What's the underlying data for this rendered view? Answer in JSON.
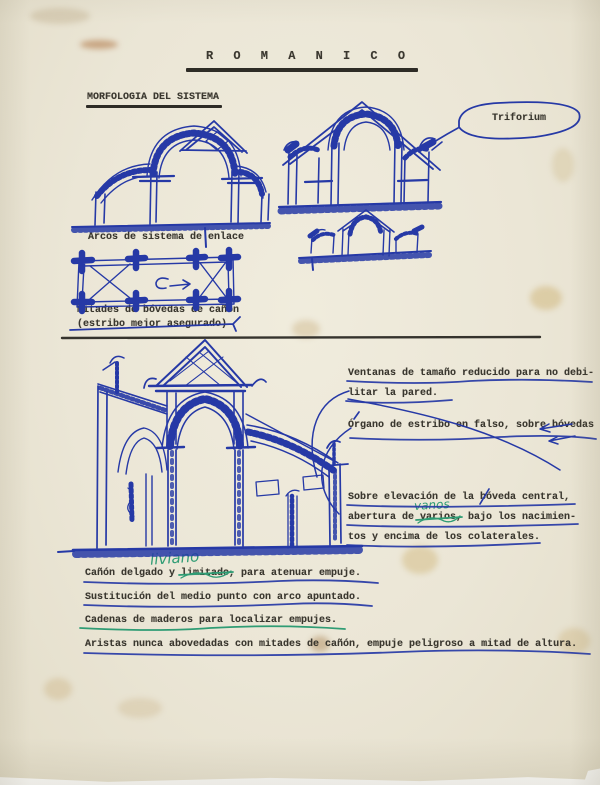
{
  "document": {
    "title": "R O M A N I C O",
    "section_heading": "MORFOLOGIA DEL SISTEMA",
    "captions": {
      "arcos": "Arcos de sistema de enlace",
      "mitades_1": "Mitades de bóvedas de cañón",
      "mitades_2": "(estribo mejor asegurado)",
      "triforium": "Triforium"
    },
    "side_notes": {
      "ventanas_1": "Ventanas de tamaño reducido para no debi-",
      "ventanas_2": "litar la pared.",
      "organo": "Órgano de estribo en falso, sobre bóvedas",
      "sobre_1": "Sobre elevación de la bóveda central,",
      "sobre_2_pre": "abertura de ",
      "sobre_2_struck": "varios,",
      "sobre_2_post": " bajo los nacimien-",
      "sobre_3": "tos y encima de los colaterales.",
      "handwritten_correction": "vanos"
    },
    "bottom_notes": {
      "canon_pre": "Cañón delgado y ",
      "canon_struck": "limitado",
      "canon_post": ", para atenuar empuje.",
      "handwritten_correction": "liviano",
      "sustitucion": "Sustitución del medio punto con arco apuntado.",
      "cadenas": "Cadenas de maderos para localizar empujes.",
      "aristas": "Aristas nunca abovedadas con mitades de cañón, empuje peligroso a mitad de altura."
    },
    "colors": {
      "paper": "#ebe6d6",
      "typewriter_ink": "#3a372f",
      "pen_blue": "#2639a6",
      "pen_green": "#2f9c74"
    }
  }
}
